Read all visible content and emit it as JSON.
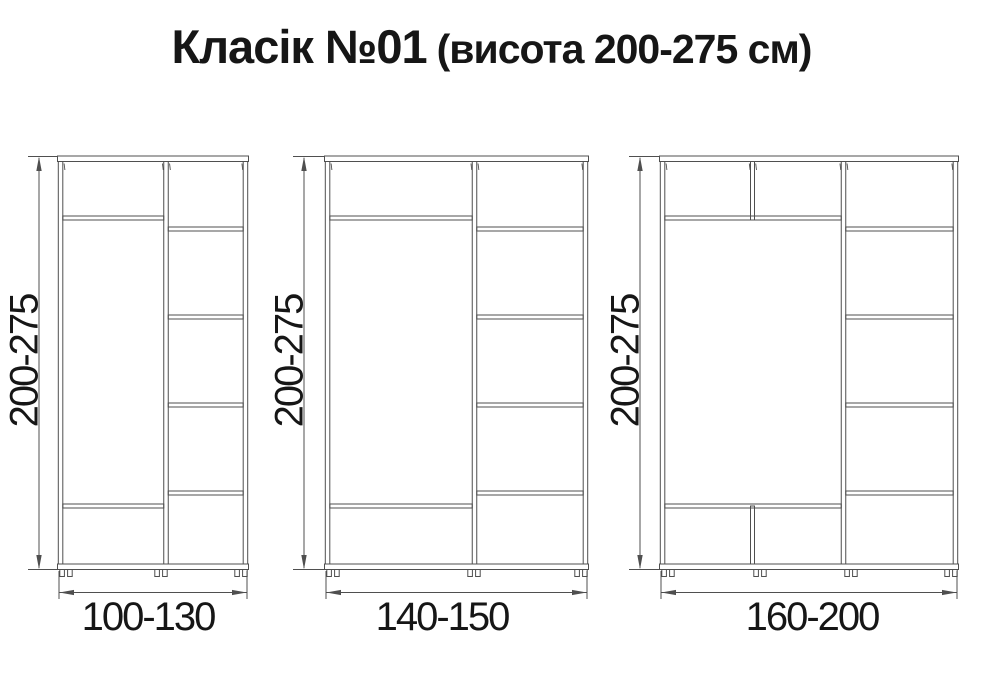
{
  "title": {
    "product": "Класік №01",
    "height_note": "(висота 200-275 см)"
  },
  "wardrobes": [
    {
      "name": "wardrobe-small",
      "height_label": "200-275",
      "width_label": "100-130"
    },
    {
      "name": "wardrobe-medium",
      "height_label": "200-275",
      "width_label": "140-150"
    },
    {
      "name": "wardrobe-large",
      "height_label": "200-275",
      "width_label": "160-200"
    }
  ],
  "colors": {
    "line": "#4f4f4f",
    "text": "#161616",
    "background": "#ffffff"
  }
}
